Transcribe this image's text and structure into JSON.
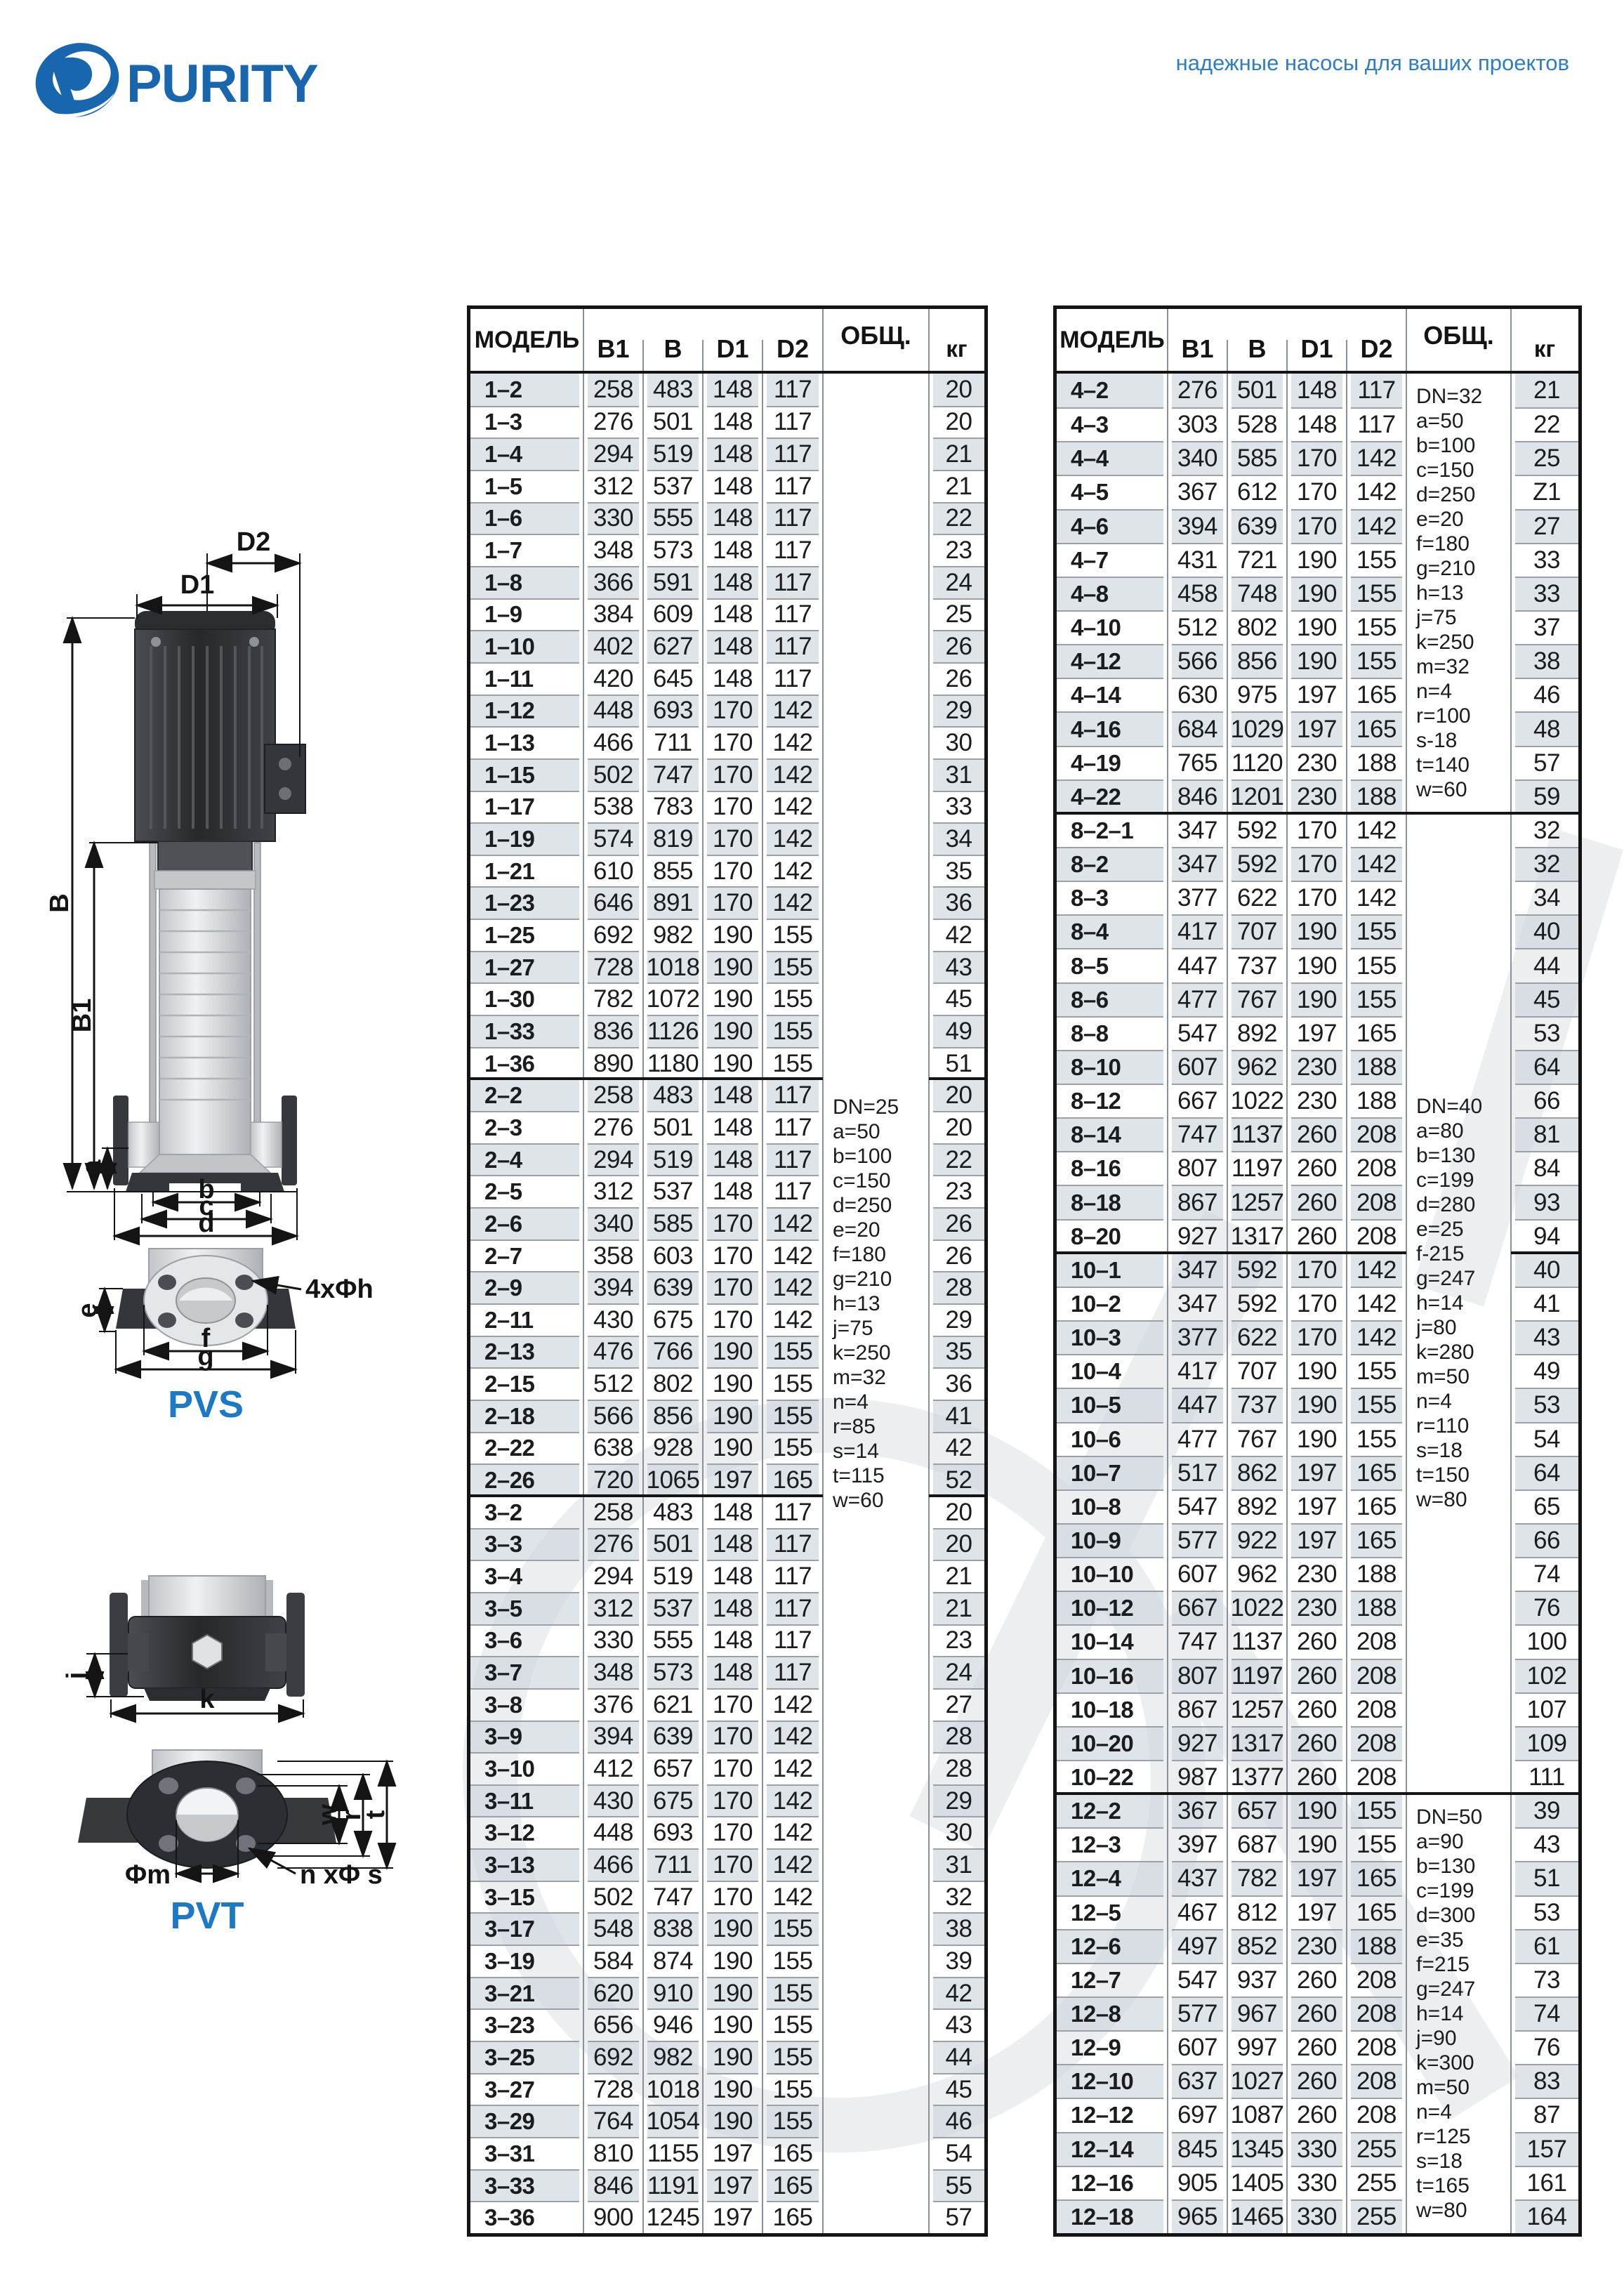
{
  "page": {
    "tagline": "надежные насосы для ваших проектов"
  },
  "logo": {
    "text": "PURITY"
  },
  "drawings": {
    "pvs": {
      "label": "PVS",
      "dims": {
        "d2": "D2",
        "d1": "D1",
        "b": "B",
        "b1": "B1",
        "a": "a",
        "b_dim": "b",
        "c": "c",
        "d": "d",
        "e": "e",
        "f": "f",
        "g": "g",
        "holes": "4xΦh"
      }
    },
    "pvt": {
      "label": "PVT",
      "dims": {
        "j": "j",
        "k": "k",
        "w": "w",
        "r": "r",
        "t": "t",
        "m": "Φm",
        "holes": "n xΦ s"
      }
    }
  },
  "tables": {
    "left": {
      "columns": {
        "model": "МОДЕЛЬ",
        "b1": "B1",
        "b": "B",
        "d1": "D1",
        "d2": "D2",
        "obsh": "ОБЩ.",
        "kg": "кг"
      },
      "rows": [
        [
          "1–2",
          "258",
          "483",
          "148",
          "117",
          "20"
        ],
        [
          "1–3",
          "276",
          "501",
          "148",
          "117",
          "20"
        ],
        [
          "1–4",
          "294",
          "519",
          "148",
          "117",
          "21"
        ],
        [
          "1–5",
          "312",
          "537",
          "148",
          "117",
          "21"
        ],
        [
          "1–6",
          "330",
          "555",
          "148",
          "117",
          "22"
        ],
        [
          "1–7",
          "348",
          "573",
          "148",
          "117",
          "23"
        ],
        [
          "1–8",
          "366",
          "591",
          "148",
          "117",
          "24"
        ],
        [
          "1–9",
          "384",
          "609",
          "148",
          "117",
          "25"
        ],
        [
          "1–10",
          "402",
          "627",
          "148",
          "117",
          "26"
        ],
        [
          "1–11",
          "420",
          "645",
          "148",
          "117",
          "26"
        ],
        [
          "1–12",
          "448",
          "693",
          "170",
          "142",
          "29"
        ],
        [
          "1–13",
          "466",
          "711",
          "170",
          "142",
          "30"
        ],
        [
          "1–15",
          "502",
          "747",
          "170",
          "142",
          "31"
        ],
        [
          "1–17",
          "538",
          "783",
          "170",
          "142",
          "33"
        ],
        [
          "1–19",
          "574",
          "819",
          "170",
          "142",
          "34"
        ],
        [
          "1–21",
          "610",
          "855",
          "170",
          "142",
          "35"
        ],
        [
          "1–23",
          "646",
          "891",
          "170",
          "142",
          "36"
        ],
        [
          "1–25",
          "692",
          "982",
          "190",
          "155",
          "42"
        ],
        [
          "1–27",
          "728",
          "1018",
          "190",
          "155",
          "43"
        ],
        [
          "1–30",
          "782",
          "1072",
          "190",
          "155",
          "45"
        ],
        [
          "1–33",
          "836",
          "1126",
          "190",
          "155",
          "49"
        ],
        [
          "1–36",
          "890",
          "1180",
          "190",
          "155",
          "51"
        ],
        [
          "2–2",
          "258",
          "483",
          "148",
          "117",
          "20"
        ],
        [
          "2–3",
          "276",
          "501",
          "148",
          "117",
          "20"
        ],
        [
          "2–4",
          "294",
          "519",
          "148",
          "117",
          "22"
        ],
        [
          "2–5",
          "312",
          "537",
          "148",
          "117",
          "23"
        ],
        [
          "2–6",
          "340",
          "585",
          "170",
          "142",
          "26"
        ],
        [
          "2–7",
          "358",
          "603",
          "170",
          "142",
          "26"
        ],
        [
          "2–9",
          "394",
          "639",
          "170",
          "142",
          "28"
        ],
        [
          "2–11",
          "430",
          "675",
          "170",
          "142",
          "29"
        ],
        [
          "2–13",
          "476",
          "766",
          "190",
          "155",
          "35"
        ],
        [
          "2–15",
          "512",
          "802",
          "190",
          "155",
          "36"
        ],
        [
          "2–18",
          "566",
          "856",
          "190",
          "155",
          "41"
        ],
        [
          "2–22",
          "638",
          "928",
          "190",
          "155",
          "42"
        ],
        [
          "2–26",
          "720",
          "1065",
          "197",
          "165",
          "52"
        ],
        [
          "3–2",
          "258",
          "483",
          "148",
          "117",
          "20"
        ],
        [
          "3–3",
          "276",
          "501",
          "148",
          "117",
          "20"
        ],
        [
          "3–4",
          "294",
          "519",
          "148",
          "117",
          "21"
        ],
        [
          "3–5",
          "312",
          "537",
          "148",
          "117",
          "21"
        ],
        [
          "3–6",
          "330",
          "555",
          "148",
          "117",
          "23"
        ],
        [
          "3–7",
          "348",
          "573",
          "148",
          "117",
          "24"
        ],
        [
          "3–8",
          "376",
          "621",
          "170",
          "142",
          "27"
        ],
        [
          "3–9",
          "394",
          "639",
          "170",
          "142",
          "28"
        ],
        [
          "3–10",
          "412",
          "657",
          "170",
          "142",
          "28"
        ],
        [
          "3–11",
          "430",
          "675",
          "170",
          "142",
          "29"
        ],
        [
          "3–12",
          "448",
          "693",
          "170",
          "142",
          "30"
        ],
        [
          "3–13",
          "466",
          "711",
          "170",
          "142",
          "31"
        ],
        [
          "3–15",
          "502",
          "747",
          "170",
          "142",
          "32"
        ],
        [
          "3–17",
          "548",
          "838",
          "190",
          "155",
          "38"
        ],
        [
          "3–19",
          "584",
          "874",
          "190",
          "155",
          "39"
        ],
        [
          "3–21",
          "620",
          "910",
          "190",
          "155",
          "42"
        ],
        [
          "3–23",
          "656",
          "946",
          "190",
          "155",
          "43"
        ],
        [
          "3–25",
          "692",
          "982",
          "190",
          "155",
          "44"
        ],
        [
          "3–27",
          "728",
          "1018",
          "190",
          "155",
          "45"
        ],
        [
          "3–29",
          "764",
          "1054",
          "190",
          "155",
          "46"
        ],
        [
          "3–31",
          "810",
          "1155",
          "197",
          "165",
          "54"
        ],
        [
          "3–33",
          "846",
          "1191",
          "197",
          "165",
          "55"
        ],
        [
          "3–36",
          "900",
          "1245",
          "197",
          "165",
          "57"
        ]
      ],
      "group_breaks": [
        22,
        35
      ],
      "obsh_breaks": [],
      "notes": [
        {
          "start": 1,
          "end": 58,
          "lines": [
            "DN=25",
            "a=50",
            "b=100",
            "c=150",
            "d=250",
            "e=20",
            "f=180",
            "g=210",
            "h=13",
            "j=75",
            "k=250",
            "m=32",
            "n=4",
            "r=85",
            "s=14",
            "t=115",
            "w=60"
          ]
        }
      ]
    },
    "right": {
      "columns": {
        "model": "МОДЕЛЬ",
        "b1": "B1",
        "b": "B",
        "d1": "D1",
        "d2": "D2",
        "obsh": "ОБЩ.",
        "kg": "кг"
      },
      "rows": [
        [
          "4–2",
          "276",
          "501",
          "148",
          "117",
          "21"
        ],
        [
          "4–3",
          "303",
          "528",
          "148",
          "117",
          "22"
        ],
        [
          "4–4",
          "340",
          "585",
          "170",
          "142",
          "25"
        ],
        [
          "4–5",
          "367",
          "612",
          "170",
          "142",
          "Z1"
        ],
        [
          "4–6",
          "394",
          "639",
          "170",
          "142",
          "27"
        ],
        [
          "4–7",
          "431",
          "721",
          "190",
          "155",
          "33"
        ],
        [
          "4–8",
          "458",
          "748",
          "190",
          "155",
          "33"
        ],
        [
          "4–10",
          "512",
          "802",
          "190",
          "155",
          "37"
        ],
        [
          "4–12",
          "566",
          "856",
          "190",
          "155",
          "38"
        ],
        [
          "4–14",
          "630",
          "975",
          "197",
          "165",
          "46"
        ],
        [
          "4–16",
          "684",
          "1029",
          "197",
          "165",
          "48"
        ],
        [
          "4–19",
          "765",
          "1120",
          "230",
          "188",
          "57"
        ],
        [
          "4–22",
          "846",
          "1201",
          "230",
          "188",
          "59"
        ],
        [
          "8–2–1",
          "347",
          "592",
          "170",
          "142",
          "32"
        ],
        [
          "8–2",
          "347",
          "592",
          "170",
          "142",
          "32"
        ],
        [
          "8–3",
          "377",
          "622",
          "170",
          "142",
          "34"
        ],
        [
          "8–4",
          "417",
          "707",
          "190",
          "155",
          "40"
        ],
        [
          "8–5",
          "447",
          "737",
          "190",
          "155",
          "44"
        ],
        [
          "8–6",
          "477",
          "767",
          "190",
          "155",
          "45"
        ],
        [
          "8–8",
          "547",
          "892",
          "197",
          "165",
          "53"
        ],
        [
          "8–10",
          "607",
          "962",
          "230",
          "188",
          "64"
        ],
        [
          "8–12",
          "667",
          "1022",
          "230",
          "188",
          "66"
        ],
        [
          "8–14",
          "747",
          "1137",
          "260",
          "208",
          "81"
        ],
        [
          "8–16",
          "807",
          "1197",
          "260",
          "208",
          "84"
        ],
        [
          "8–18",
          "867",
          "1257",
          "260",
          "208",
          "93"
        ],
        [
          "8–20",
          "927",
          "1317",
          "260",
          "208",
          "94"
        ],
        [
          "10–1",
          "347",
          "592",
          "170",
          "142",
          "40"
        ],
        [
          "10–2",
          "347",
          "592",
          "170",
          "142",
          "41"
        ],
        [
          "10–3",
          "377",
          "622",
          "170",
          "142",
          "43"
        ],
        [
          "10–4",
          "417",
          "707",
          "190",
          "155",
          "49"
        ],
        [
          "10–5",
          "447",
          "737",
          "190",
          "155",
          "53"
        ],
        [
          "10–6",
          "477",
          "767",
          "190",
          "155",
          "54"
        ],
        [
          "10–7",
          "517",
          "862",
          "197",
          "165",
          "64"
        ],
        [
          "10–8",
          "547",
          "892",
          "197",
          "165",
          "65"
        ],
        [
          "10–9",
          "577",
          "922",
          "197",
          "165",
          "66"
        ],
        [
          "10–10",
          "607",
          "962",
          "230",
          "188",
          "74"
        ],
        [
          "10–12",
          "667",
          "1022",
          "230",
          "188",
          "76"
        ],
        [
          "10–14",
          "747",
          "1137",
          "260",
          "208",
          "100"
        ],
        [
          "10–16",
          "807",
          "1197",
          "260",
          "208",
          "102"
        ],
        [
          "10–18",
          "867",
          "1257",
          "260",
          "208",
          "107"
        ],
        [
          "10–20",
          "927",
          "1317",
          "260",
          "208",
          "109"
        ],
        [
          "10–22",
          "987",
          "1377",
          "260",
          "208",
          "111"
        ],
        [
          "12–2",
          "367",
          "657",
          "190",
          "155",
          "39"
        ],
        [
          "12–3",
          "397",
          "687",
          "190",
          "155",
          "43"
        ],
        [
          "12–4",
          "437",
          "782",
          "197",
          "165",
          "51"
        ],
        [
          "12–5",
          "467",
          "812",
          "197",
          "165",
          "53"
        ],
        [
          "12–6",
          "497",
          "852",
          "230",
          "188",
          "61"
        ],
        [
          "12–7",
          "547",
          "937",
          "260",
          "208",
          "73"
        ],
        [
          "12–8",
          "577",
          "967",
          "260",
          "208",
          "74"
        ],
        [
          "12–9",
          "607",
          "997",
          "260",
          "208",
          "76"
        ],
        [
          "12–10",
          "637",
          "1027",
          "260",
          "208",
          "83"
        ],
        [
          "12–12",
          "697",
          "1087",
          "260",
          "208",
          "87"
        ],
        [
          "12–14",
          "845",
          "1345",
          "330",
          "255",
          "157"
        ],
        [
          "12–16",
          "905",
          "1405",
          "330",
          "255",
          "161"
        ],
        [
          "12–18",
          "965",
          "1465",
          "330",
          "255",
          "164"
        ]
      ],
      "group_breaks": [
        13,
        26,
        42
      ],
      "obsh_breaks": [
        13,
        42
      ],
      "notes": [
        {
          "start": 1,
          "end": 13,
          "lines": [
            "DN=32",
            "a=50",
            "b=100",
            "c=150",
            "d=250",
            "e=20",
            "f=180",
            "g=210",
            "h=13",
            "j=75",
            "k=250",
            "m=32",
            "n=4",
            "r=100",
            "s-18",
            "t=140",
            "w=60"
          ]
        },
        {
          "start": 14,
          "end": 42,
          "lines": [
            "DN=40",
            "a=80",
            "b=130",
            "c=199",
            "d=280",
            "e=25",
            "f-215",
            "g=247",
            "h=14",
            "j=80",
            "k=280",
            "m=50",
            "n=4",
            "r=110",
            "s=18",
            "t=150",
            "w=80"
          ]
        },
        {
          "start": 43,
          "end": 55,
          "lines": [
            "DN=50",
            "a=90",
            "b=130",
            "c=199",
            "d=300",
            "e=35",
            "f=215",
            "g=247",
            "h=14",
            "j=90",
            "k=300",
            "m=50",
            "n=4",
            "r=125",
            "s=18",
            "t=165",
            "w=80"
          ]
        }
      ]
    }
  }
}
